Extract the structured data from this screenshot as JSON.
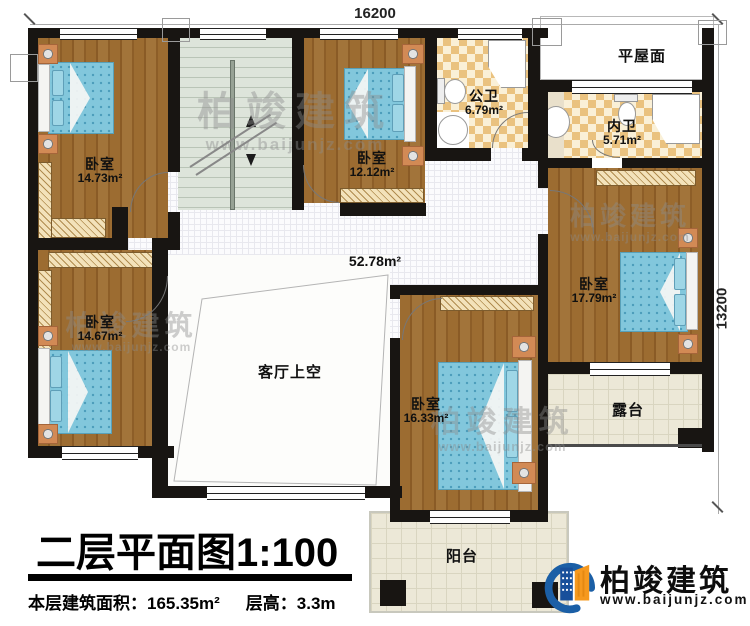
{
  "plan": {
    "dim_top": "16200",
    "dim_right": "13200"
  },
  "rooms": {
    "bedroom_tl": {
      "name": "卧室",
      "area": "14.73m²"
    },
    "bedroom_tm": {
      "name": "卧室",
      "area": "12.12m²"
    },
    "bath_public": {
      "name": "公卫",
      "area": "6.79m²"
    },
    "flat_roof": {
      "name": "平屋面"
    },
    "bath_inner": {
      "name": "内卫",
      "area": "5.71m²"
    },
    "bedroom_r": {
      "name": "卧室",
      "area": "17.79m²"
    },
    "hall": {
      "area": "52.78m²"
    },
    "bedroom_bl": {
      "name": "卧室",
      "area": "14.67m²"
    },
    "void": {
      "name": "客厅上空"
    },
    "bedroom_bm": {
      "name": "卧室",
      "area": "16.33m²"
    },
    "terrace": {
      "name": "露台"
    },
    "balcony": {
      "name": "阳台"
    }
  },
  "title_block": {
    "title": "二层平面图1:100",
    "area_label": "本层建筑面积：",
    "area_value": "165.35m²",
    "height_label": "层高：",
    "height_value": "3.3m"
  },
  "brand": {
    "name": "柏竣建筑",
    "url": "www.baijunjz.com"
  },
  "watermark": {
    "name": "柏竣建筑",
    "url": "www.baijunjz.com"
  },
  "colors": {
    "wall": "#181512",
    "wood": "#96672e",
    "accent_blue": "#1b5fa6",
    "accent_orange": "#f6991e"
  }
}
